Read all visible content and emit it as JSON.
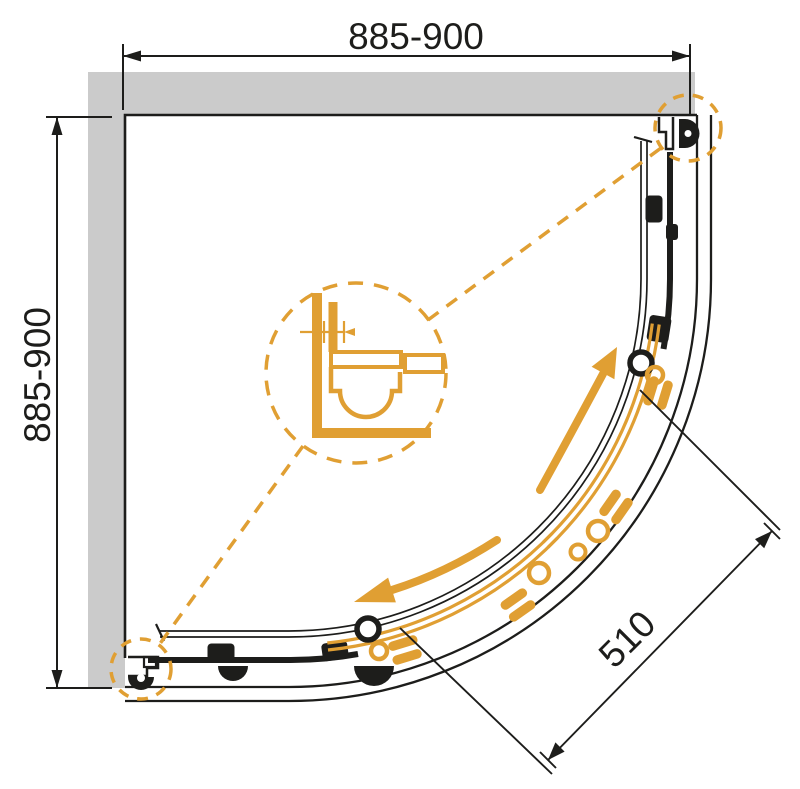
{
  "diagram": {
    "dimensions": {
      "top": "885-900",
      "left": "885-900",
      "diagonal": "510",
      "detail_range": "0-15",
      "detail_unit": "MM"
    },
    "colors": {
      "accent": "#E09F33",
      "wall": "#CBCBCB",
      "line": "#1D1D1B",
      "background": "#FFFFFF"
    }
  }
}
